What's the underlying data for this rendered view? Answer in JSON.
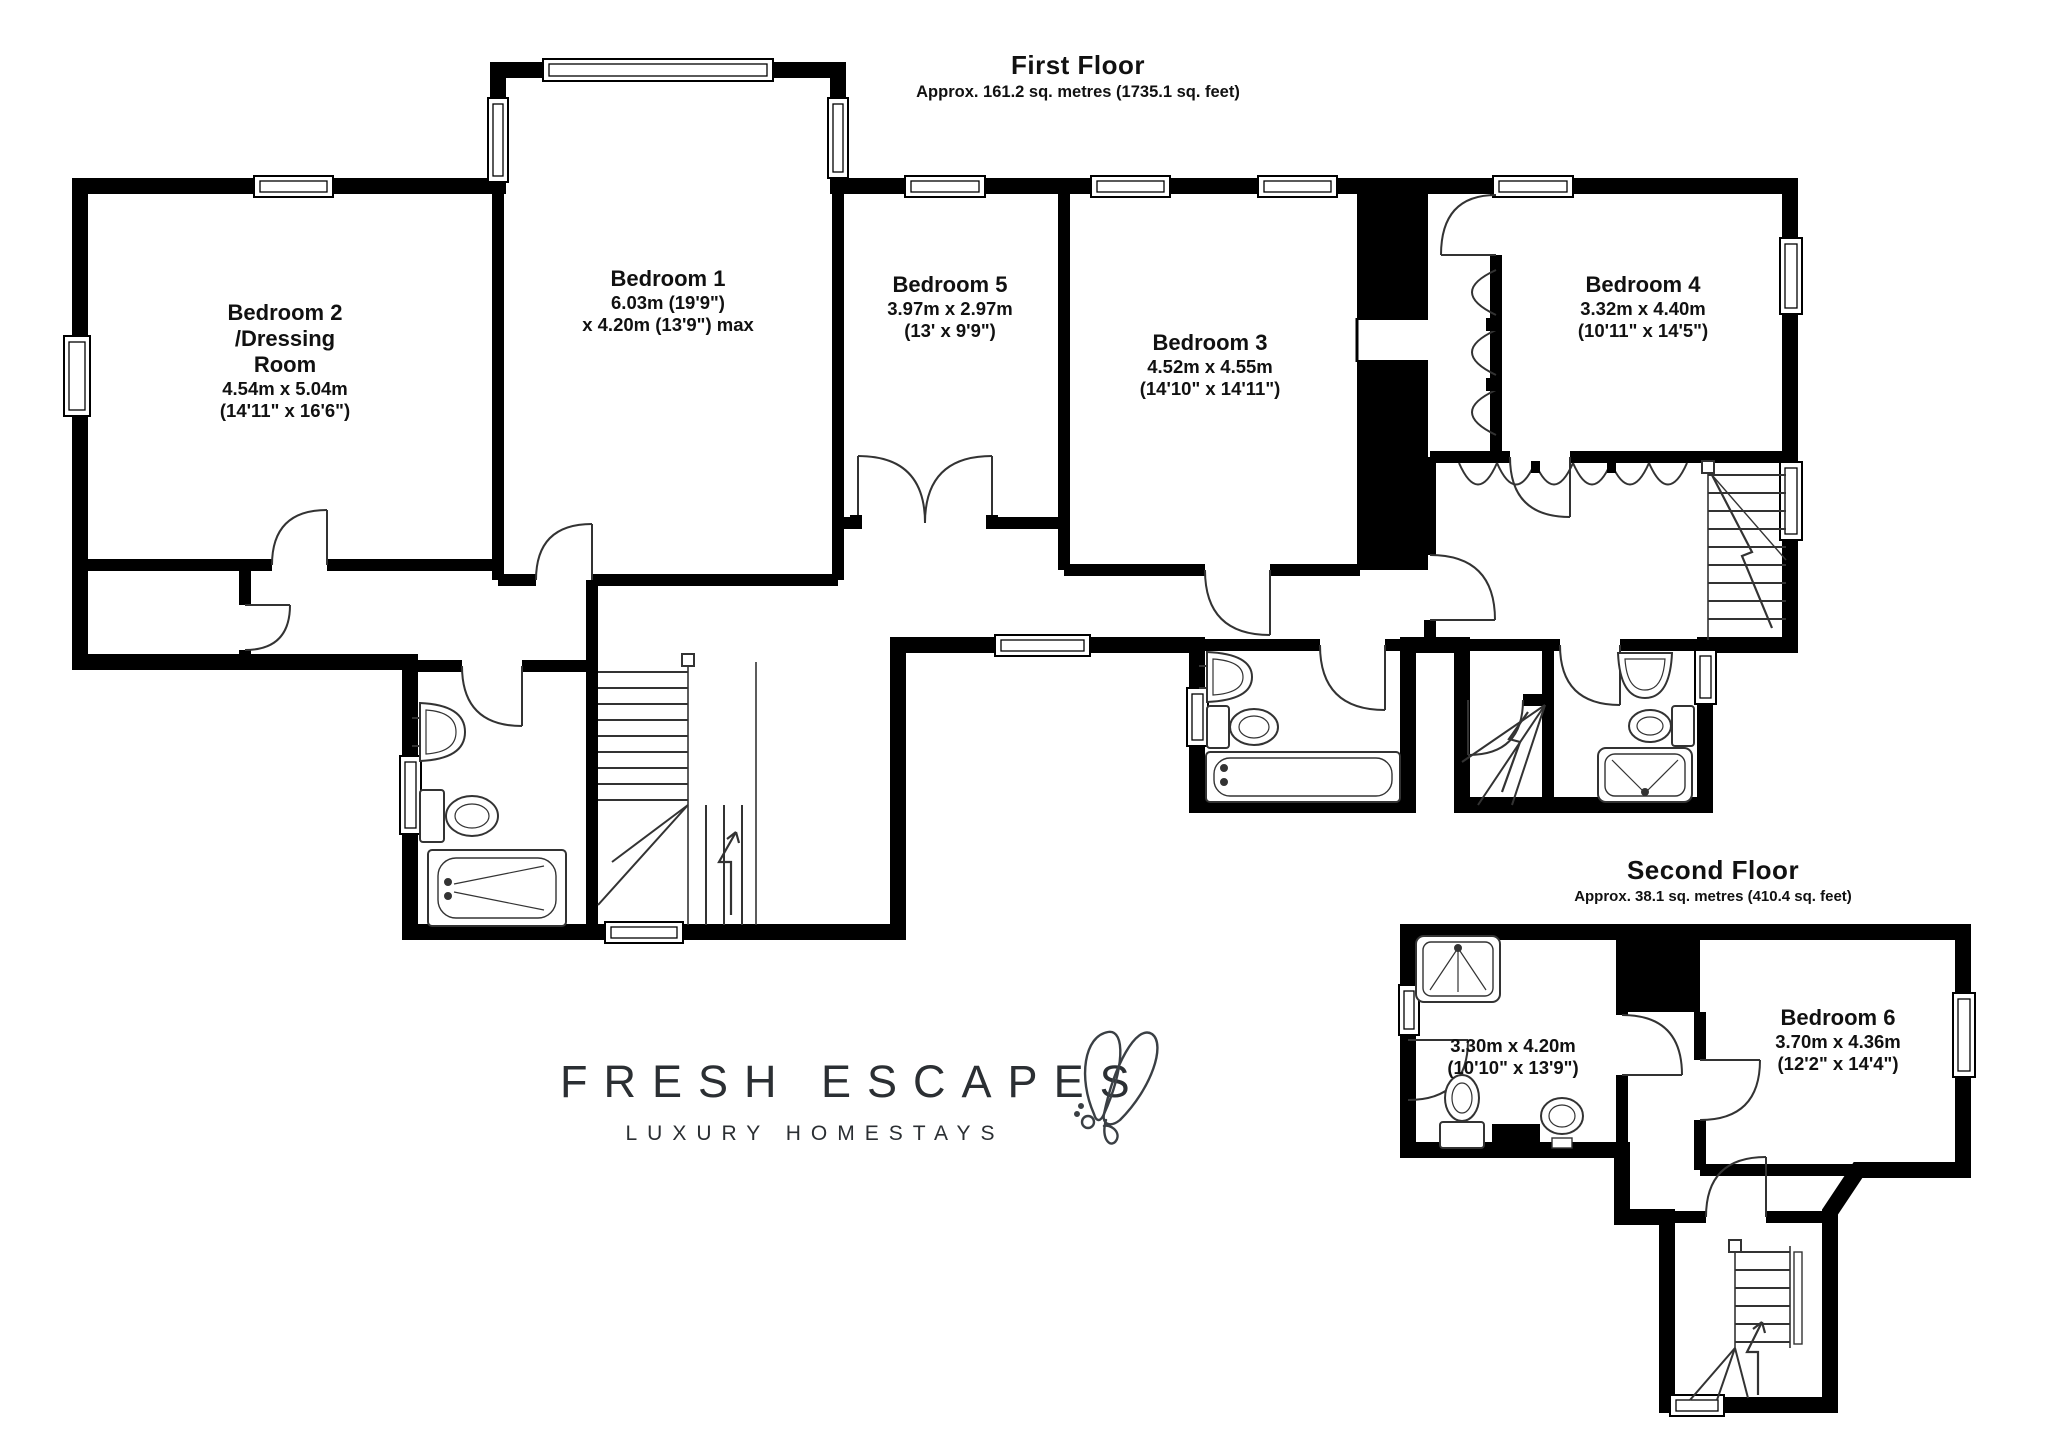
{
  "floors": {
    "first": {
      "title": "First Floor",
      "subtitle": "Approx. 161.2 sq. metres (1735.1 sq. feet)",
      "rooms": {
        "bedroom2": {
          "name": "Bedroom 2",
          "name2": "/Dressing",
          "name3": "Room",
          "dims_m": "4.54m x 5.04m",
          "dims_ft": "(14'11\" x 16'6\")"
        },
        "bedroom1": {
          "name": "Bedroom 1",
          "dims_m": "6.03m (19'9\")",
          "dims_ft": "x 4.20m (13'9\") max"
        },
        "bedroom5": {
          "name": "Bedroom 5",
          "dims_m": "3.97m x 2.97m",
          "dims_ft": "(13' x 9'9\")"
        },
        "bedroom3": {
          "name": "Bedroom 3",
          "dims_m": "4.52m x 4.55m",
          "dims_ft": "(14'10\" x 14'11\")"
        },
        "bedroom4": {
          "name": "Bedroom 4",
          "dims_m": "3.32m x 4.40m",
          "dims_ft": "(10'11\" x 14'5\")"
        }
      }
    },
    "second": {
      "title": "Second Floor",
      "subtitle": "Approx. 38.1 sq. metres (410.4 sq. feet)",
      "rooms": {
        "bathroom": {
          "dims_m": "3.30m x 4.20m",
          "dims_ft": "(10'10\" x 13'9\")"
        },
        "bedroom6": {
          "name": "Bedroom 6",
          "dims_m": "3.70m x 4.36m",
          "dims_ft": "(12'2\" x 14'4\")"
        }
      }
    }
  },
  "logo": {
    "brand": "FRESH ESCAPES",
    "tagline": "LUXURY HOMESTAYS"
  },
  "colors": {
    "wall": "#000000",
    "line": "#222222",
    "background": "#ffffff"
  }
}
